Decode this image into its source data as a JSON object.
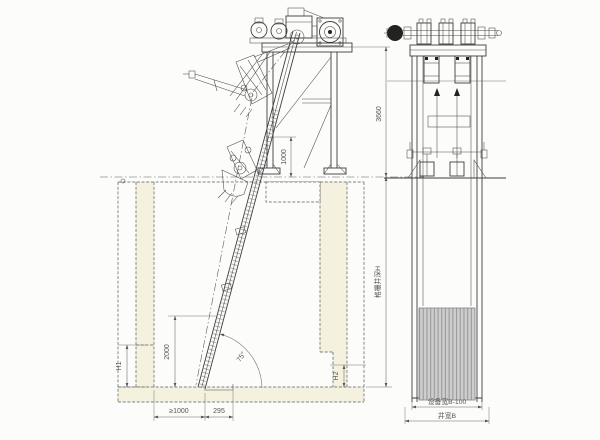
{
  "dimensions": {
    "side_view": {
      "frame_height": "3660",
      "discharge_clearance": "1000",
      "rake_travel": "2000",
      "incline_angle": "75°",
      "left_step_depth": "H1",
      "right_step_depth": "H2",
      "floor_clearance": "≥1000",
      "screen_foot_width": "295",
      "pit_depth_label": "格栅井深H"
    },
    "front_view": {
      "equipment_width": "设备宽B-100",
      "channel_width": "井宽B"
    }
  },
  "colors": {
    "line": "#3d3d3d",
    "dimension": "#555555",
    "concrete_fill": "#f5f1df",
    "rack_fill": "#cdcdcd",
    "rack_hatch": "#9b9b9b",
    "background": "#fcfcfb"
  }
}
